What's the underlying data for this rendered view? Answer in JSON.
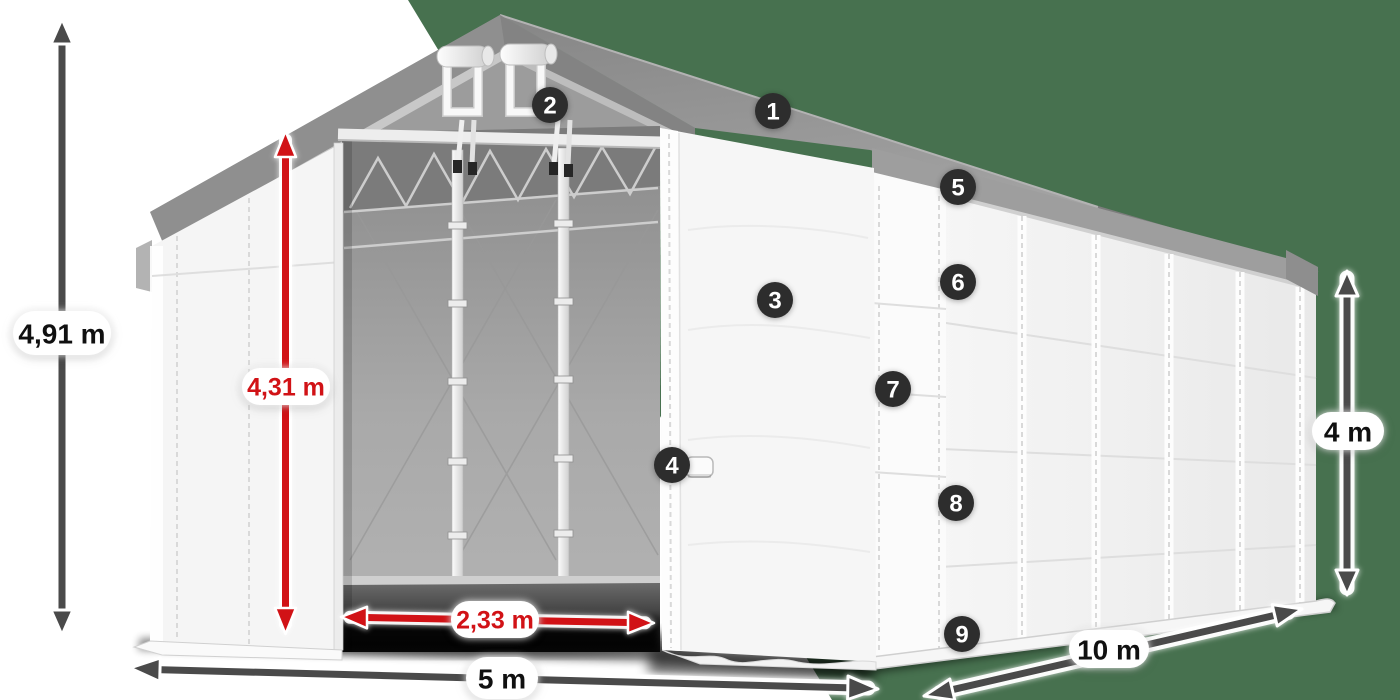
{
  "scene": {
    "description": "Storage tent (gable marquee) product diagram, front-left view with open door, numbered part callouts and dimension arrows"
  },
  "colors": {
    "background_left": "#ffffff",
    "background_right_panel": "#47714f",
    "dimension_arrow": "#4a4a4a",
    "dimension_red": "#d11216",
    "marker_bg": "#2d2d2d",
    "marker_text": "#ffffff",
    "roof_gray": "#939393",
    "wall_white": "#f5f5f5"
  },
  "dimensions": {
    "total_height": "4,91 m",
    "clear_door_height": "4,31 m",
    "door_width": "2,33 m",
    "tent_width": "5 m",
    "tent_length": "10 m",
    "side_wall_height": "4 m"
  },
  "markers": [
    {
      "number": "1"
    },
    {
      "number": "2"
    },
    {
      "number": "3"
    },
    {
      "number": "4"
    },
    {
      "number": "5"
    },
    {
      "number": "6"
    },
    {
      "number": "7"
    },
    {
      "number": "8"
    },
    {
      "number": "9"
    }
  ]
}
